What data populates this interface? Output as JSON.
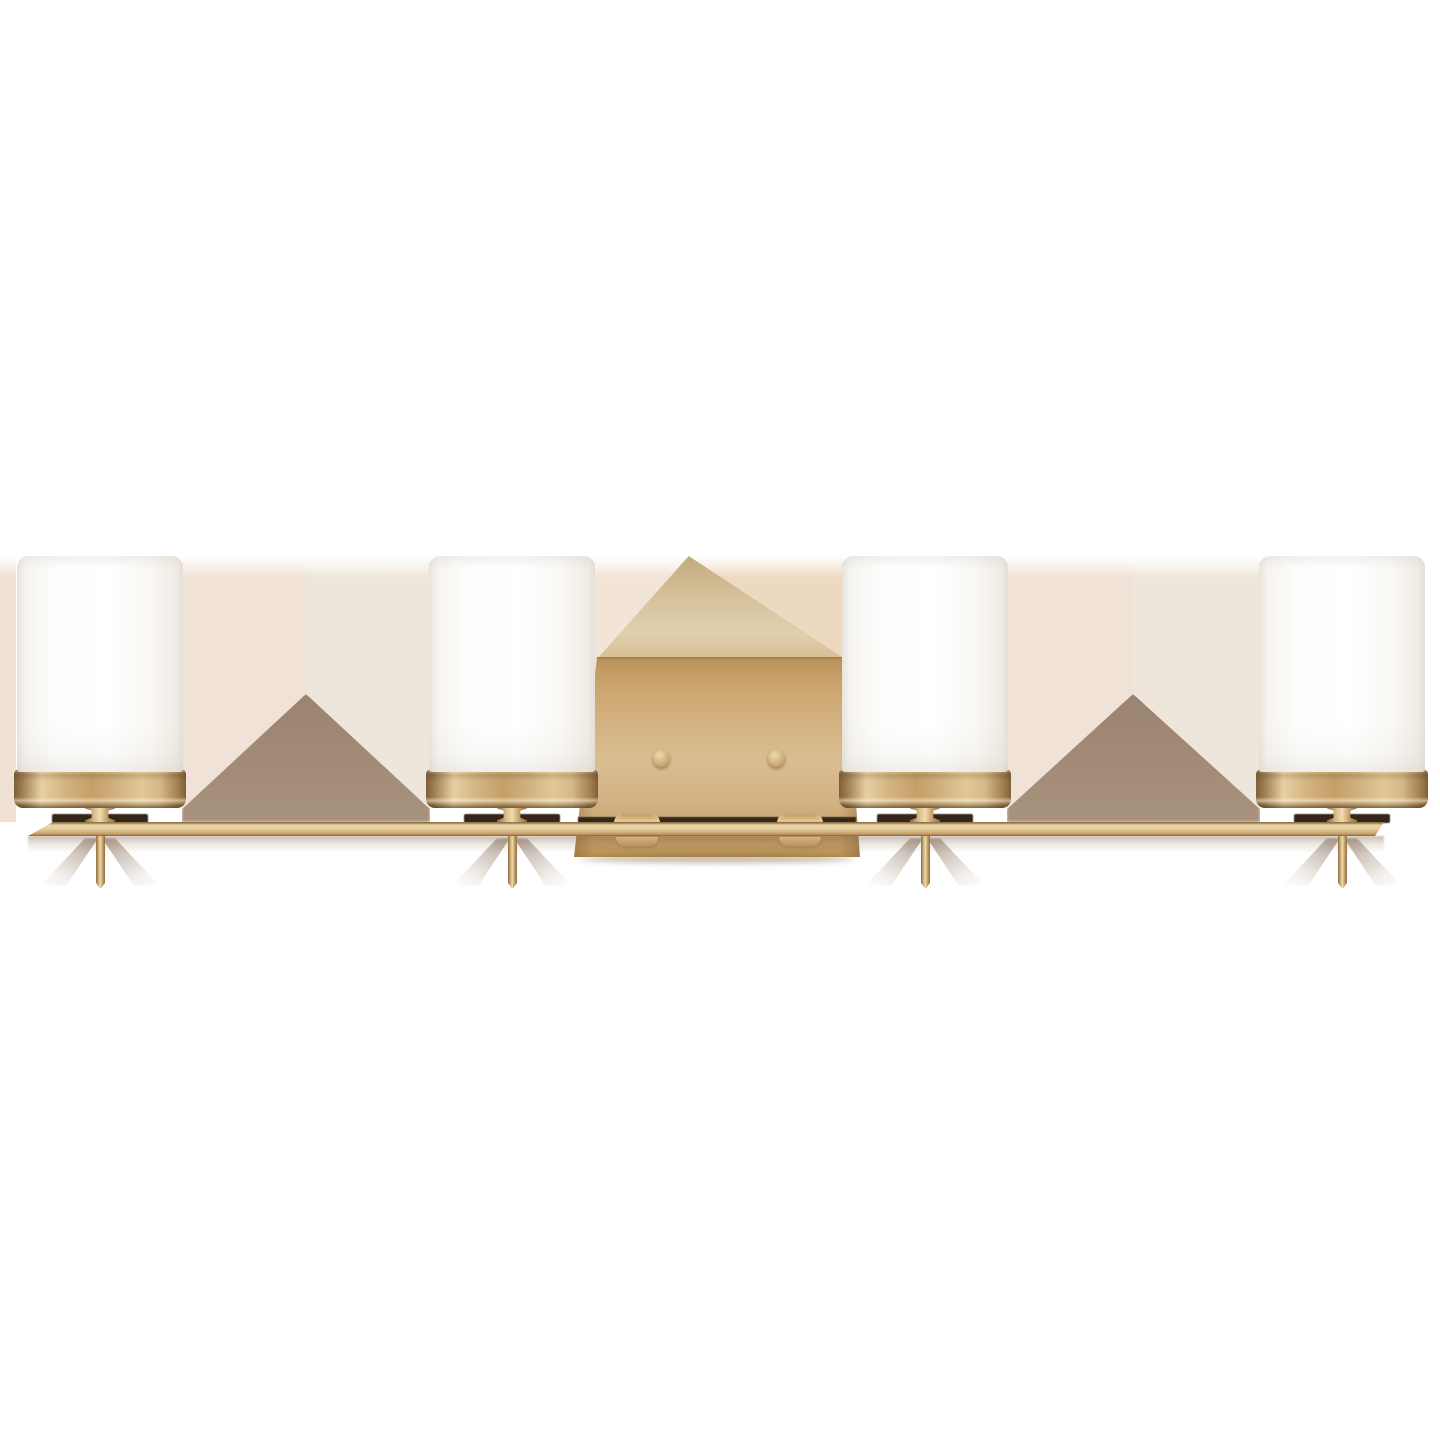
{
  "canvas": {
    "width": 1440,
    "height": 1440,
    "background": "#FFFFFF"
  },
  "product": {
    "description": "Four-light bath vanity wall fixture, satin brass finish, four cylindrical etched white opal glass shades on a long horizontal brass bar with rectangular center backplate and downward stems",
    "light_count": 4,
    "finish_color_name": "satin brass",
    "shade_color_name": "etched white opal glass"
  },
  "colors": {
    "background": "#FFFFFF",
    "brass-dark": "#7E6039",
    "brass-mid": "#C69F68",
    "brass-light": "#E8CFA0",
    "brass-bright": "#F0DCB0",
    "bar-face": "#E9D6A7",
    "bar-deep": "#C09760",
    "plate-top": "#B8905A",
    "plate-mid": "#DABE92",
    "plate-low": "#BB9254",
    "peak-light": "#E0CFAF",
    "peak-tan": "#C3AA80",
    "glass-white": "#FDFDFC",
    "glass-edge": "#E7E3DC",
    "glass-shadow": "#EFEBE5",
    "socket-shadow": "#33271A",
    "tri-top": "#9A8370",
    "tri-base": "#A8937E",
    "stem-shadow": "rgba(112,86,60,0.55)"
  },
  "fixture": {
    "lights": [
      {
        "cx": 100
      },
      {
        "cx": 512
      },
      {
        "cx": 925
      },
      {
        "cx": 1342
      }
    ],
    "bar": {
      "left": 28,
      "top": 822,
      "width": 1356,
      "height": 14
    },
    "backplate": {
      "left": 574,
      "top": 556,
      "width": 286,
      "height": 301,
      "peak_x": 689,
      "screws": [
        {
          "cx": 661,
          "cy": 758
        },
        {
          "cx": 776,
          "cy": 758
        }
      ],
      "tabs": [
        {
          "cx": 637
        },
        {
          "cx": 800
        }
      ]
    },
    "gaps": [
      {
        "left": 0,
        "width": 16,
        "split": 8,
        "tintL": "#F0E1D4",
        "tintR": "#F0E1D4",
        "triangle": false
      },
      {
        "left": 182,
        "width": 248,
        "split": 306,
        "tintL": "#F1E2D7",
        "tintR": "#EFE6DB",
        "triangle": true,
        "peak_y": 694
      },
      {
        "left": 594,
        "width": 249,
        "split": 689,
        "tintL": "#F2E4D6",
        "tintR": "#EDD9C0",
        "triangle": false
      },
      {
        "left": 1007,
        "width": 253,
        "split": 1133,
        "tintL": "#F1E2D7",
        "tintR": "#EFE6DB",
        "triangle": true,
        "peak_y": 694
      }
    ]
  }
}
